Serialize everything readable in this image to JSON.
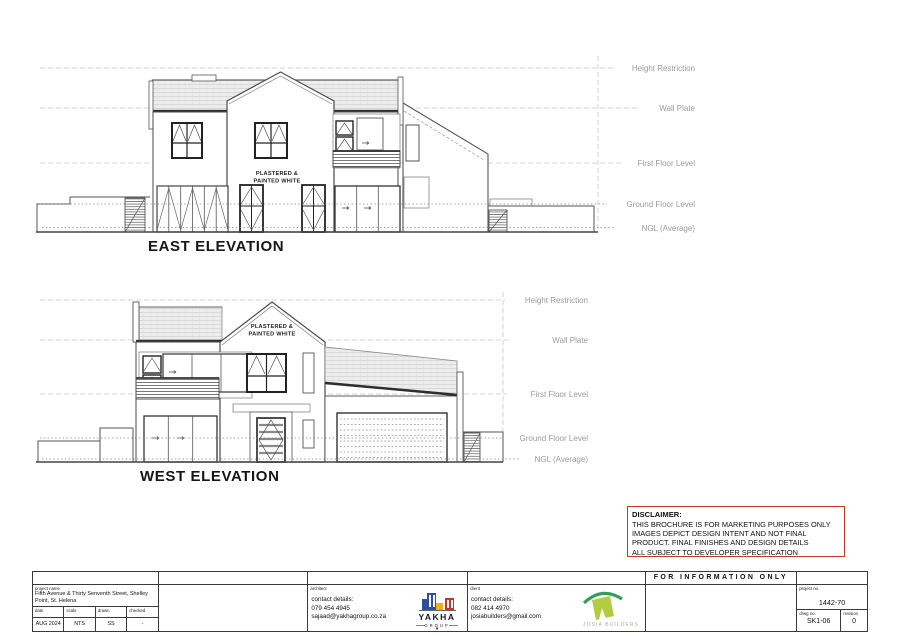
{
  "elevations": {
    "east": {
      "title": "EAST ELEVATION",
      "wall_note": [
        "PLASTERED &",
        "PAINTED WHITE"
      ],
      "levels": [
        "Height Restriction",
        "Wall Plate",
        "First Floor Level",
        "Ground Floor Level",
        "NGL (Average)"
      ]
    },
    "west": {
      "title": "WEST ELEVATION",
      "wall_note": [
        "PLASTERED &",
        "PAINTED WHITE"
      ],
      "levels": [
        "Height Restriction",
        "Wall Plate",
        "First Floor Level",
        "Ground Floor Level",
        "NGL (Average)"
      ]
    }
  },
  "disclaimer": {
    "title": "DISCLAIMER:",
    "lines": [
      "THIS BROCHURE IS FOR MARKETING PURPOSES ONLY",
      "IMAGES DEPICT DESIGN INTENT AND NOT FINAL",
      "PRODUCT. FINAL FINISHES AND DESIGN DETAILS",
      "ALL SUBJECT TO DEVELOPER SPECIFICATION"
    ]
  },
  "title_block": {
    "project": {
      "label": "project name",
      "name": "Fifth Avenue & Thirty Senventh Street, Shelley Point, St. Helena",
      "date_label": "date",
      "date": "AUG 2024",
      "scale_label": "scale",
      "scale": "NTS",
      "drawn_label": "drawn",
      "drawn": "SS",
      "checked_label": "checked",
      "checked": "-"
    },
    "architect": {
      "label": "architect",
      "contact_label": "contact details:",
      "phone": "079 454 4945",
      "email": "sajaad@yakhagroup.co.za",
      "logo_name": "YAKHA",
      "logo_sub": "GROUP"
    },
    "client": {
      "label": "client",
      "contact_label": "contact details:",
      "phone": "082 414 4970",
      "email": "josiabuilders@gmail.com",
      "logo_name": "JOSIA BUILDERS"
    },
    "stamp": "FOR INFORMATION ONLY",
    "numbers": {
      "project_no_label": "project no.",
      "project_no": "1442-70",
      "drwg_no_label": "drwg no.",
      "drwg_no": "SK1-06",
      "revision_label": "revision",
      "revision": "0"
    }
  },
  "colors": {
    "line": "#4a4a4a",
    "roof_fill": "#ededed",
    "level_line": "#c6c6c6",
    "level_text": "#9b9b9b",
    "disclaimer_border": "#c0392b",
    "yakha_blue": "#2e4f9e",
    "yakha_yellow": "#e9b50b",
    "yakha_red": "#c8342a",
    "josia_green_light": "#b2cc3f",
    "josia_green_dark": "#2fa05a",
    "josia_text": "#b3ac9a"
  }
}
